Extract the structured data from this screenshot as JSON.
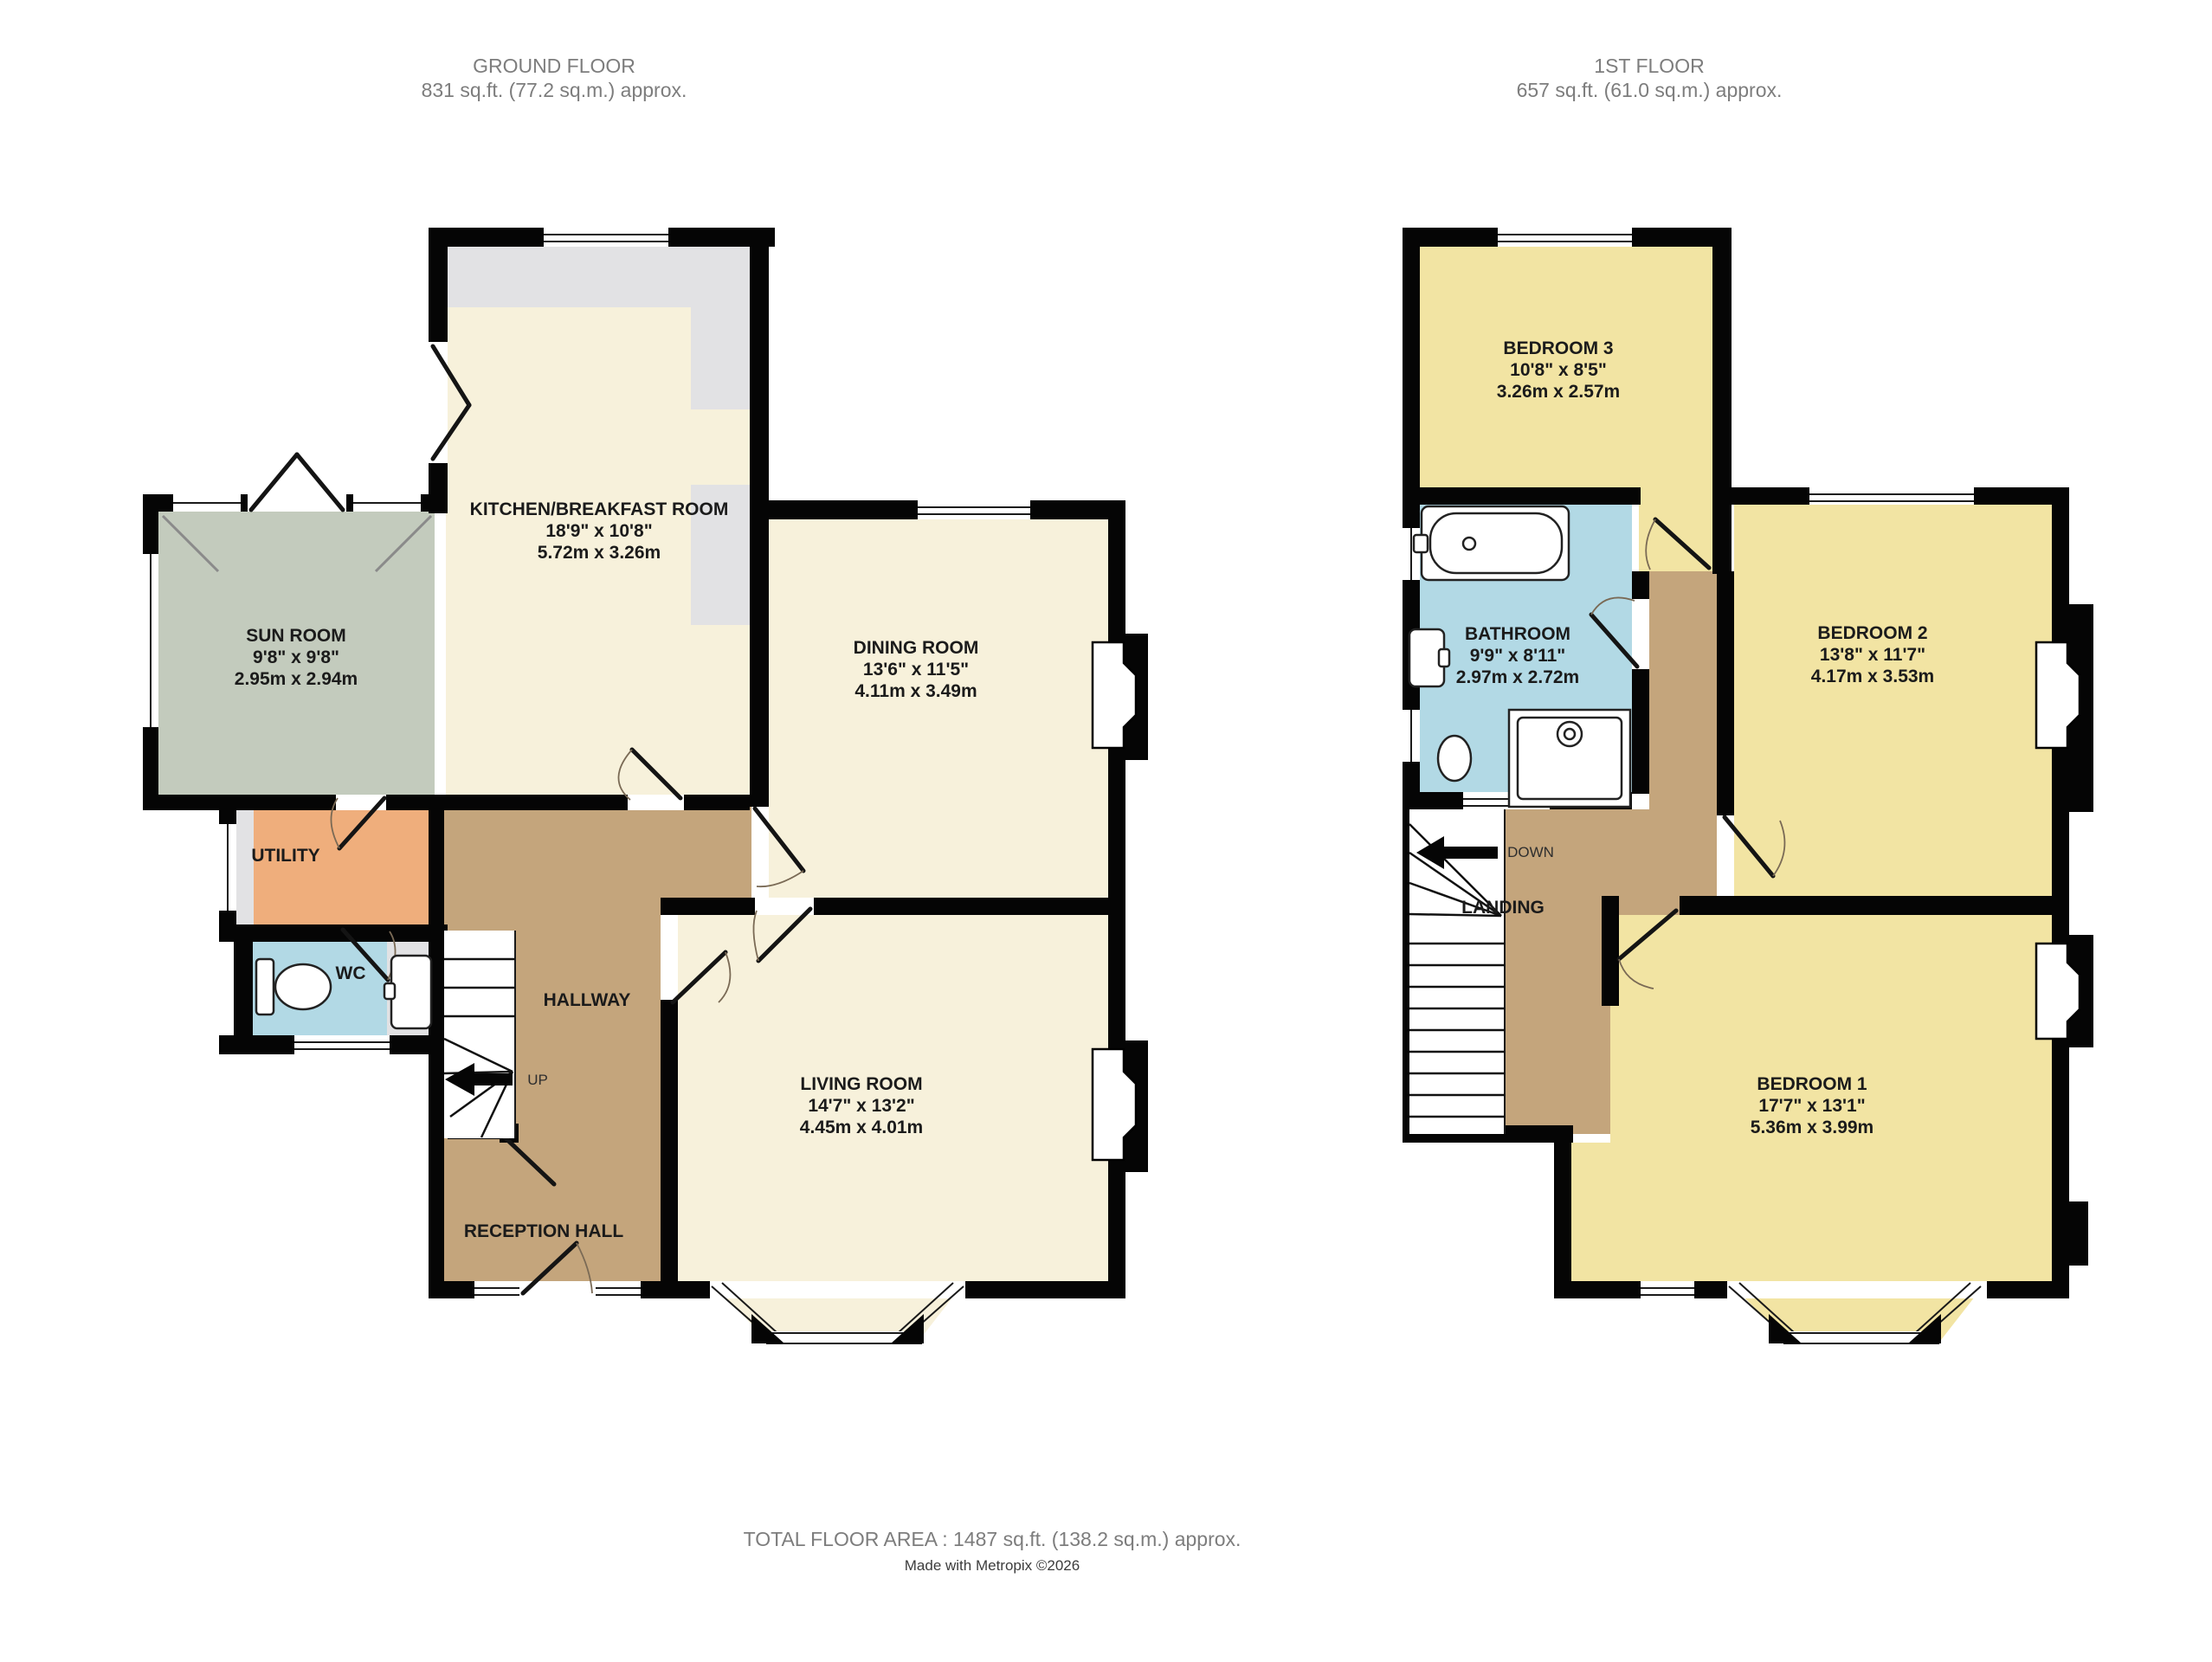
{
  "ground_floor": {
    "title": "GROUND FLOOR",
    "area": "831 sq.ft. (77.2 sq.m.) approx.",
    "rooms": {
      "sun_room": {
        "name": "SUN ROOM",
        "imperial": "9'8\" x 9'8\"",
        "metric": "2.95m x 2.94m"
      },
      "kitchen": {
        "name": "KITCHEN/BREAKFAST ROOM",
        "imperial": "18'9\" x 10'8\"",
        "metric": "5.72m x 3.26m"
      },
      "dining": {
        "name": "DINING ROOM",
        "imperial": "13'6\" x 11'5\"",
        "metric": "4.11m x 3.49m"
      },
      "living": {
        "name": "LIVING ROOM",
        "imperial": "14'7\" x 13'2\"",
        "metric": "4.45m x 4.01m"
      },
      "utility": {
        "name": "UTILITY"
      },
      "wc": {
        "name": "WC"
      },
      "hallway": {
        "name": "HALLWAY"
      },
      "reception": {
        "name": "RECEPTION HALL"
      },
      "stairs_label": "UP"
    }
  },
  "first_floor": {
    "title": "1ST FLOOR",
    "area": "657 sq.ft. (61.0 sq.m.) approx.",
    "rooms": {
      "bedroom3": {
        "name": "BEDROOM 3",
        "imperial": "10'8\" x 8'5\"",
        "metric": "3.26m x 2.57m"
      },
      "bathroom": {
        "name": "BATHROOM",
        "imperial": "9'9\" x 8'11\"",
        "metric": "2.97m x 2.72m"
      },
      "bedroom2": {
        "name": "BEDROOM 2",
        "imperial": "13'8\" x 11'7\"",
        "metric": "4.17m x 3.53m"
      },
      "bedroom1": {
        "name": "BEDROOM 1",
        "imperial": "17'7\" x 13'1\"",
        "metric": "5.36m x 3.99m"
      },
      "landing": {
        "name": "LANDING"
      },
      "stairs_label": "DOWN"
    }
  },
  "footer": {
    "total_area": "TOTAL FLOOR AREA : 1487 sq.ft. (138.2 sq.m.) approx.",
    "credit": "Made with Metropix ©2026"
  },
  "colors": {
    "wall": "#050505",
    "cream": "#F7F1DB",
    "bedroom_yellow": "#F2E4A3",
    "sun_room_green": "#C3CBBD",
    "utility_orange": "#EFAE7C",
    "bathroom_blue": "#B2D9E5",
    "hall_tan": "#C4A57C",
    "unit_gray": "#E2E2E4",
    "label_text": "#1B1B1B",
    "header_text": "#7D7D7D"
  }
}
